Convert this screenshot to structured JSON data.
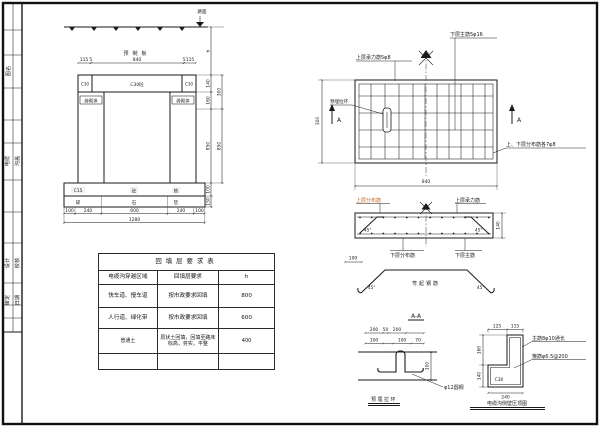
{
  "colors": {
    "ink": "#1a1a1a",
    "accent": "#c4641d"
  },
  "titleblock": {
    "cell1_left": "图名",
    "cell1_right": "",
    "cell2_left": "电缆",
    "cell2_right": "沟盖",
    "cell3_left": "设计",
    "cell3_right": "校核",
    "cell4_left": "审定",
    "cell4_right": "日期"
  },
  "cross_section": {
    "road_label": "路面",
    "cap_label": "预制板",
    "cap_center": "C30砼",
    "cap_end": "C30",
    "wall": "砖砌体",
    "bed1": {
      "a": "C15",
      "b": "砼",
      "c": "垫"
    },
    "bed2": {
      "a": "碎",
      "b": "石",
      "c": "垫"
    },
    "dims_top": [
      "115",
      "5",
      "840",
      "5",
      "115"
    ],
    "dims_bottom": [
      "100",
      "240",
      "600",
      "240",
      "100"
    ],
    "dim_total": "1280",
    "dims_right": {
      "h": "h",
      "d140": "140",
      "d160": "160",
      "d850": "850",
      "d100": "100",
      "d150": "150",
      "d300": "300",
      "d850b": "850"
    }
  },
  "plan": {
    "label_top": "上层承力筋5φ8",
    "label_main": "下层主筋5φ16",
    "label_ring": "预埋拉环",
    "label_dist": "上、下层分布筋各7φ8",
    "marker_a": "A",
    "dim_w": "840",
    "dim_h": "300"
  },
  "section": {
    "upper_dist": "上层分布筋",
    "upper_main": "上层承力筋",
    "lower_dist": "下层分布筋",
    "lower_main": "下层主筋",
    "angle": "45°",
    "thick": "140",
    "hook": "100",
    "bent": "弯起钢筋"
  },
  "ring_detail": {
    "title": "A-A",
    "r1": [
      "200",
      "50",
      "200"
    ],
    "r2": [
      "100",
      "100",
      "70"
    ],
    "height": "100",
    "bar": "φ12圆钢",
    "caption": "预埋拉环"
  },
  "coping_detail": {
    "top": [
      "125",
      "115"
    ],
    "left": [
      "160",
      "140"
    ],
    "bottom": "240",
    "main": "主筋8φ10通长",
    "stirrup": "箍筋φ6.5@200",
    "grade": "C30",
    "caption": "电缆沟侧壁压顶图"
  },
  "table": {
    "title": "回填层要求表",
    "header": [
      "电缆沟穿越区域",
      "回填层要求",
      "h"
    ],
    "rows": [
      [
        "快车道、慢车道",
        "按市政要求回填",
        "800"
      ],
      [
        "人行道、绿化带",
        "按市政要求回填",
        "600"
      ],
      [
        "普通土",
        "原状土回填，回填至路床标高，夯实，平整",
        "400"
      ],
      [
        "",
        "",
        ""
      ]
    ]
  }
}
